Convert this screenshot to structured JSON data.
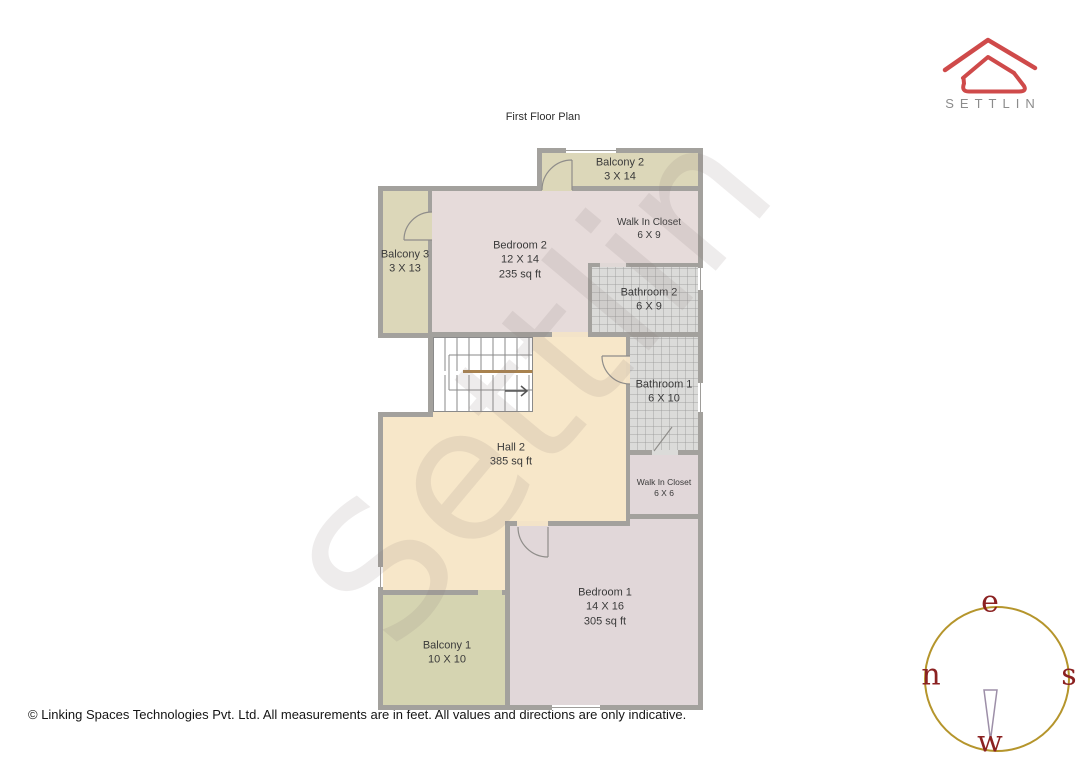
{
  "title": "First Floor Plan",
  "brand": {
    "name": "SETTLIN"
  },
  "watermark": "Settlin",
  "rooms": [
    {
      "name": "Balcony 2",
      "size": "3 X 14"
    },
    {
      "name": "Walk In Closet",
      "size": "6 X 9"
    },
    {
      "name": "Bedroom 2",
      "size": "12 X 14",
      "area": "235 sq ft"
    },
    {
      "name": "Balcony 3",
      "size": "3 X 13"
    },
    {
      "name": "Bathroom 2",
      "size": "6 X 9"
    },
    {
      "name": "Bathroom 1",
      "size": "6 X 10"
    },
    {
      "name": "Hall 2",
      "area": "385 sq ft"
    },
    {
      "name": "Walk In Closet",
      "size": "6 X 6"
    },
    {
      "name": "Bedroom 1",
      "size": "14 X 16",
      "area": "305 sq ft"
    },
    {
      "name": "Balcony 1",
      "size": "10 X 10"
    }
  ],
  "compass": {
    "top": "e",
    "left": "n",
    "right": "s",
    "bottom": "w"
  },
  "footer": "© Linking Spaces Technologies Pvt. Ltd. All measurements are in feet. All values and directions are only indicative.",
  "palette": {
    "hall": "#f7e7c9",
    "bedroom": "#e6dbda",
    "bedroom_alt": "#e1d7d9",
    "balcony": "#dcd7b9",
    "balcony_alt": "#d5d4b1",
    "bathroom_tile": "#dbdbd9",
    "wall": "#a3a19d",
    "stair_rail": "#a8824e",
    "compass_ring": "#b5952c",
    "compass_letters": "#8b2121",
    "logo_red": "#cf4a4a",
    "watermark_gray": "rgba(138,122,122,0.14)"
  }
}
